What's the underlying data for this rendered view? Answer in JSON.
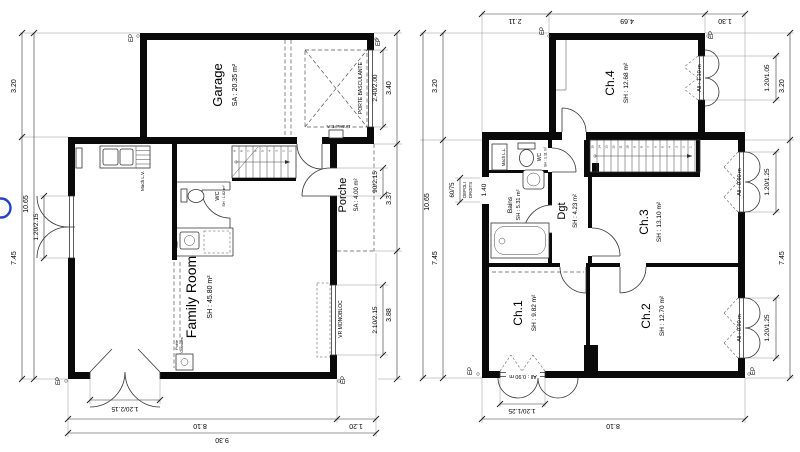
{
  "meta": {
    "ep": "EP"
  },
  "plan1": {
    "rooms": {
      "garage": {
        "name": "Garage",
        "area": "SA : 20.35 m²"
      },
      "porche": {
        "name": "Porche",
        "area": "SA : 4.00 m²"
      },
      "family_room": {
        "name": "Family Room",
        "area": "SH : 45.80 m²"
      },
      "wc": {
        "name": "WC",
        "area": "SH : 1.62 m²"
      }
    },
    "labels": {
      "porte_basculante": "PORTE BASCULANTE",
      "linteau": "Linteau B.A.",
      "vr_monobloc": "VR MONOBLOC",
      "mach_lv": "Mach L.V.",
      "lav": "Lav.",
      "poele_line1": "Poêle",
      "poele_line2": "Granulés"
    },
    "dims": {
      "left_seg_top": "3.20",
      "left_seg_bottom": "7.45",
      "left_total": "10.65",
      "left_door": "1.20/2.15",
      "right_garage_door": "2.40/2.00",
      "right_seg_top": "3.40",
      "right_porch_door": "90/2.15",
      "right_seg_mid": "3.37",
      "right_window": "2.10/2.15",
      "right_seg_bottom": "3.88",
      "bottom_door": "1.20/2.15",
      "bottom_seg_main": "8.10",
      "bottom_seg_porch": "1.20",
      "bottom_total": "9.30"
    },
    "stair_numbers": [
      "9",
      "8",
      "7",
      "6",
      "5",
      "4",
      "3",
      "2",
      "1"
    ]
  },
  "plan2": {
    "rooms": {
      "ch1": {
        "name": "Ch.1",
        "area": "SH : 9.82 m²"
      },
      "ch2": {
        "name": "Ch.2",
        "area": "SH : 12.70 m²"
      },
      "ch3": {
        "name": "Ch.3",
        "area": "SH : 13.10 m²"
      },
      "ch4": {
        "name": "Ch.4",
        "area": "SH : 12.68 m²"
      },
      "dgt": {
        "name": "Dgt",
        "area": "SH : 4.23 m²"
      },
      "bains": {
        "name": "Bains",
        "area": "SH : 5.31 m²"
      },
      "wc": {
        "name": "WC",
        "area": "SH : 1.11 m²"
      }
    },
    "labels": {
      "mach_ll": "Mach L.L.",
      "depoli_line1": "DEPOLI",
      "depoli_line2": "DROITS",
      "sill_110": "All : 1.10 m",
      "sill_090": "All : 0.90 m"
    },
    "dims": {
      "top_seg_left": "2.11",
      "top_seg_mid": "4.69",
      "top_seg_right": "1.30",
      "left_seg_top": "3.20",
      "left_seg_bottom": "7.45",
      "left_total": "10.65",
      "left_window": "60/75",
      "left_sill": "1.40",
      "right_ch4_window": "1.20/1.05",
      "right_seg_top": "3.20",
      "right_ch3_window": "1.20/1.25",
      "right_seg_bottom": "7.45",
      "right_ch2_window": "1.20/1.25",
      "bottom_window": "1.20/1.25",
      "bottom_total": "8.10"
    },
    "stair_numbers": [
      "15",
      "14",
      "13",
      "12",
      "11",
      "10",
      "9",
      "8",
      "7",
      "6",
      "5",
      "4",
      "3",
      "2",
      "1"
    ]
  }
}
